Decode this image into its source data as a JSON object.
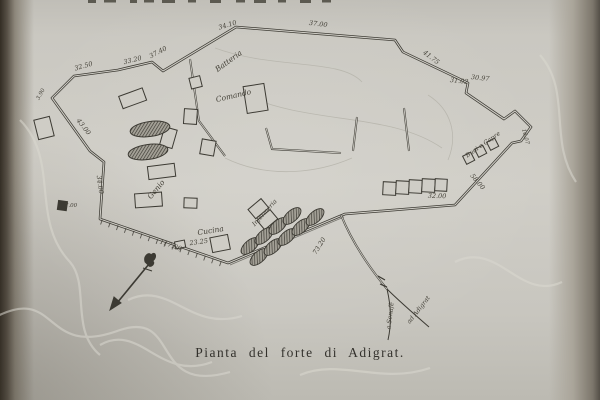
{
  "caption": "Pianta del forte di Adigrat.",
  "map": {
    "labels": {
      "batteria": "Batteria",
      "comando": "Comando",
      "genio": "Genio",
      "cucina": "Cucina",
      "infermeria": "Infermeria",
      "livestock": "Buoi e Capre",
      "road_senafe": "a Senafè",
      "road_adigrat": "ad Adigrat"
    },
    "measurements": {
      "m1": "32.50",
      "m2": "33.20",
      "m3": "37.40",
      "m4": "34.10",
      "m5": "37.00",
      "m6": "41.75",
      "m7": "31.02",
      "m8": "30.97",
      "m9": "58.00",
      "m10": "32.00",
      "m11": "73.20",
      "m12": "117.00",
      "m13": "23.25",
      "m14": "43.00",
      "m15": "34.00",
      "m16": "7.00",
      "m17": "3.90",
      "m18": "16.07"
    },
    "ink_color": "#3c3a33",
    "paper_color": "#cdcbc4"
  }
}
